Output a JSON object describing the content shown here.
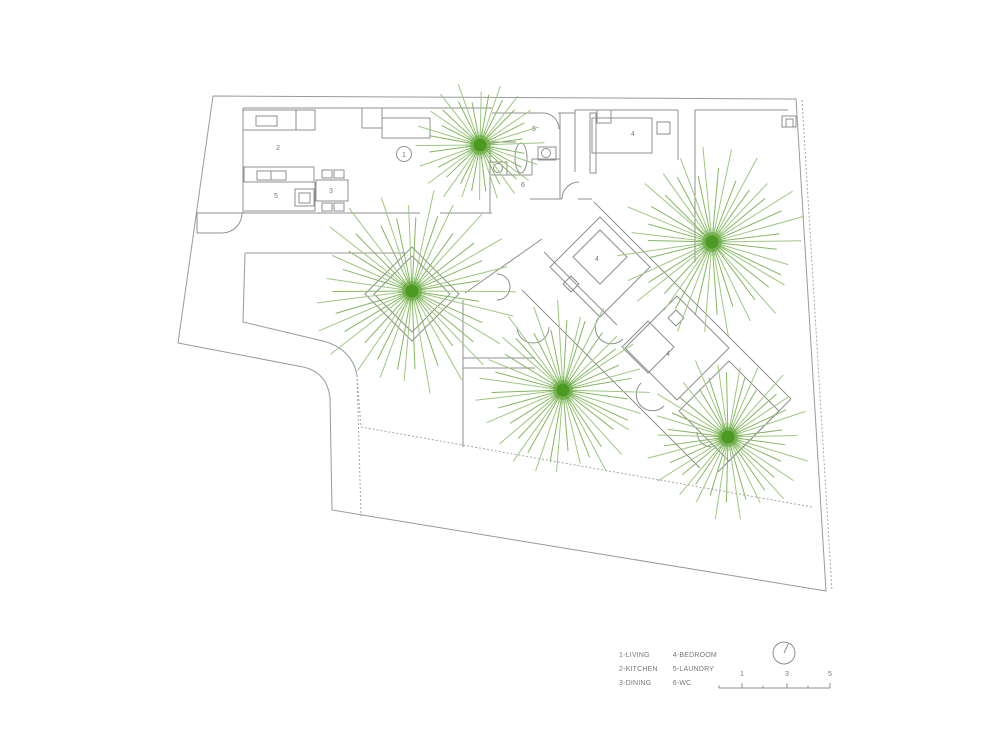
{
  "colors": {
    "wall": "#8f8f8f",
    "boundary": "#9a9a9a",
    "dashed": "#a6a6a6",
    "text": "#777777",
    "ray_a": "#9dc87e",
    "ray_b": "#83b85e",
    "tree_center": "#4c9a21"
  },
  "site": {
    "boundary_path": "M213,96 L796,99 L826,591 L332,510 L330,398 Q327,370 298,366 L178,343 Z",
    "dashed_paths": [
      "M802,100 L832,591",
      "M357,375 L361,427 L812,507",
      "M357,375 L361,516"
    ],
    "solid_paths": [
      "M245,253 L405,253",
      "M245,253 L243,322 L323,341 Q352,349 357,375"
    ]
  },
  "walls": [
    [
      243,
      108,
      492,
      108
    ],
    [
      492,
      113,
      543,
      113
    ],
    [
      558,
      113,
      575,
      113
    ],
    [
      575,
      110,
      678,
      110
    ],
    [
      695,
      110,
      788,
      110
    ],
    [
      695,
      110,
      695,
      262
    ],
    [
      243,
      108,
      243,
      213
    ],
    [
      197,
      213,
      420,
      213
    ],
    [
      440,
      213,
      492,
      213
    ],
    [
      197,
      213,
      197,
      233
    ],
    [
      197,
      233,
      222,
      233
    ],
    [
      244,
      211,
      315,
      211
    ],
    [
      315,
      182,
      315,
      211
    ],
    [
      575,
      110,
      575,
      172
    ],
    [
      678,
      110,
      678,
      160
    ],
    [
      560,
      113,
      560,
      199
    ],
    [
      488,
      142,
      516,
      142
    ],
    [
      532,
      159,
      560,
      159
    ],
    [
      532,
      159,
      532,
      175
    ],
    [
      490,
      175,
      532,
      175
    ],
    [
      530,
      199,
      562,
      199
    ],
    [
      578,
      199,
      592,
      199
    ],
    [
      490,
      142,
      490,
      213
    ],
    [
      465,
      293,
      542,
      239
    ],
    [
      522,
      290,
      616,
      384
    ],
    [
      544,
      252,
      617,
      325
    ],
    [
      594,
      202,
      791,
      399
    ],
    [
      616,
      384,
      700,
      468
    ],
    [
      791,
      399,
      718,
      472
    ],
    [
      463,
      300,
      463,
      447
    ],
    [
      463,
      358,
      535,
      358
    ],
    [
      463,
      368,
      535,
      368
    ]
  ],
  "rects": [
    [
      243,
      110,
      72,
      20
    ],
    [
      256,
      116,
      21,
      10
    ],
    [
      296,
      110,
      19,
      20
    ],
    [
      362,
      108,
      20,
      20
    ],
    [
      244,
      167,
      70,
      15
    ],
    [
      257,
      171,
      14,
      9
    ],
    [
      271,
      171,
      15,
      9
    ],
    [
      295,
      189,
      19,
      17
    ],
    [
      299,
      193,
      11,
      10
    ],
    [
      316,
      180,
      32,
      21
    ],
    [
      322,
      170,
      10,
      8
    ],
    [
      334,
      170,
      10,
      8
    ],
    [
      322,
      203,
      10,
      8
    ],
    [
      334,
      203,
      10,
      8
    ],
    [
      382,
      118,
      48,
      20
    ],
    [
      538,
      147,
      18,
      13
    ],
    [
      490,
      162,
      17,
      13
    ],
    [
      592,
      118,
      60,
      35
    ],
    [
      657,
      122,
      13,
      12
    ],
    [
      597,
      110,
      14,
      13
    ],
    [
      590,
      113,
      6,
      60
    ],
    [
      782,
      116,
      14,
      11
    ],
    [
      786,
      119,
      7,
      8
    ]
  ],
  "diamonds": [
    [
      412,
      294,
      47
    ],
    [
      412,
      294,
      38
    ],
    [
      600,
      267,
      50
    ],
    [
      600,
      257,
      27
    ],
    [
      571,
      284,
      8
    ],
    [
      677,
      348,
      52
    ],
    [
      648,
      347,
      26
    ],
    [
      676,
      318,
      8
    ],
    [
      729,
      411,
      50
    ]
  ],
  "arcs": [
    "M222,233 A20,20 0 0 0 242,213",
    "M543,113 A16,16 0 0 1 559,129",
    "M562,199 A17,17 0 0 1 579,182",
    "M497,274 A13,13 0 0 1 497,300",
    "M517,327 A16,16 0 0 0 549,327",
    "M600,316 A16,16 0 0 0 623,339",
    "M641,383 A16,16 0 0 0 664,406",
    "M697,432 A15,15 0 0 0 712,447"
  ],
  "circles": [
    [
      546,
      153,
      4.5
    ],
    [
      498,
      168,
      4.5
    ]
  ],
  "ellipses": [
    [
      521,
      158,
      6,
      15
    ]
  ],
  "room_labels": [
    {
      "t": "2",
      "x": 278,
      "y": 150
    },
    {
      "t": "5",
      "x": 276,
      "y": 198
    },
    {
      "t": "3",
      "x": 331,
      "y": 193
    },
    {
      "t": "1",
      "x": 404,
      "y": 157
    },
    {
      "t": "6",
      "x": 534,
      "y": 131
    },
    {
      "t": "6",
      "x": 523,
      "y": 187
    },
    {
      "t": "4",
      "x": 633,
      "y": 136
    },
    {
      "t": "4",
      "x": 597,
      "y": 261
    },
    {
      "t": "4",
      "x": 668,
      "y": 356
    }
  ],
  "label_circle": [
    404,
    154,
    7.5
  ],
  "trees": [
    {
      "x": 480,
      "y": 145,
      "rmin": 30,
      "rmax": 62,
      "n": 40
    },
    {
      "x": 712,
      "y": 242,
      "rmin": 45,
      "rmax": 92,
      "n": 46
    },
    {
      "x": 412,
      "y": 291,
      "rmin": 45,
      "rmax": 100,
      "n": 46
    },
    {
      "x": 563,
      "y": 390,
      "rmin": 42,
      "rmax": 88,
      "n": 46
    },
    {
      "x": 728,
      "y": 437,
      "rmin": 38,
      "rmax": 80,
      "n": 44
    }
  ],
  "legend": {
    "col1": [
      "1-LIVING",
      "2-KITCHEN",
      "3-DINING"
    ],
    "col2": [
      "4-BEDROOM",
      "5-LAUNDRY",
      "6-WC"
    ]
  },
  "north": {
    "cx": 784,
    "cy": 653,
    "r": 11,
    "hx": 788.5,
    "hy": 643.5
  },
  "scalebar": {
    "y": 688,
    "x1": 719,
    "x2": 830,
    "major_ticks": [
      742,
      787,
      830
    ],
    "minor_ticks": [
      719,
      763,
      808
    ],
    "labels": [
      {
        "t": "1",
        "x": 737
      },
      {
        "t": "3",
        "x": 782
      },
      {
        "t": "5",
        "x": 825
      }
    ]
  }
}
